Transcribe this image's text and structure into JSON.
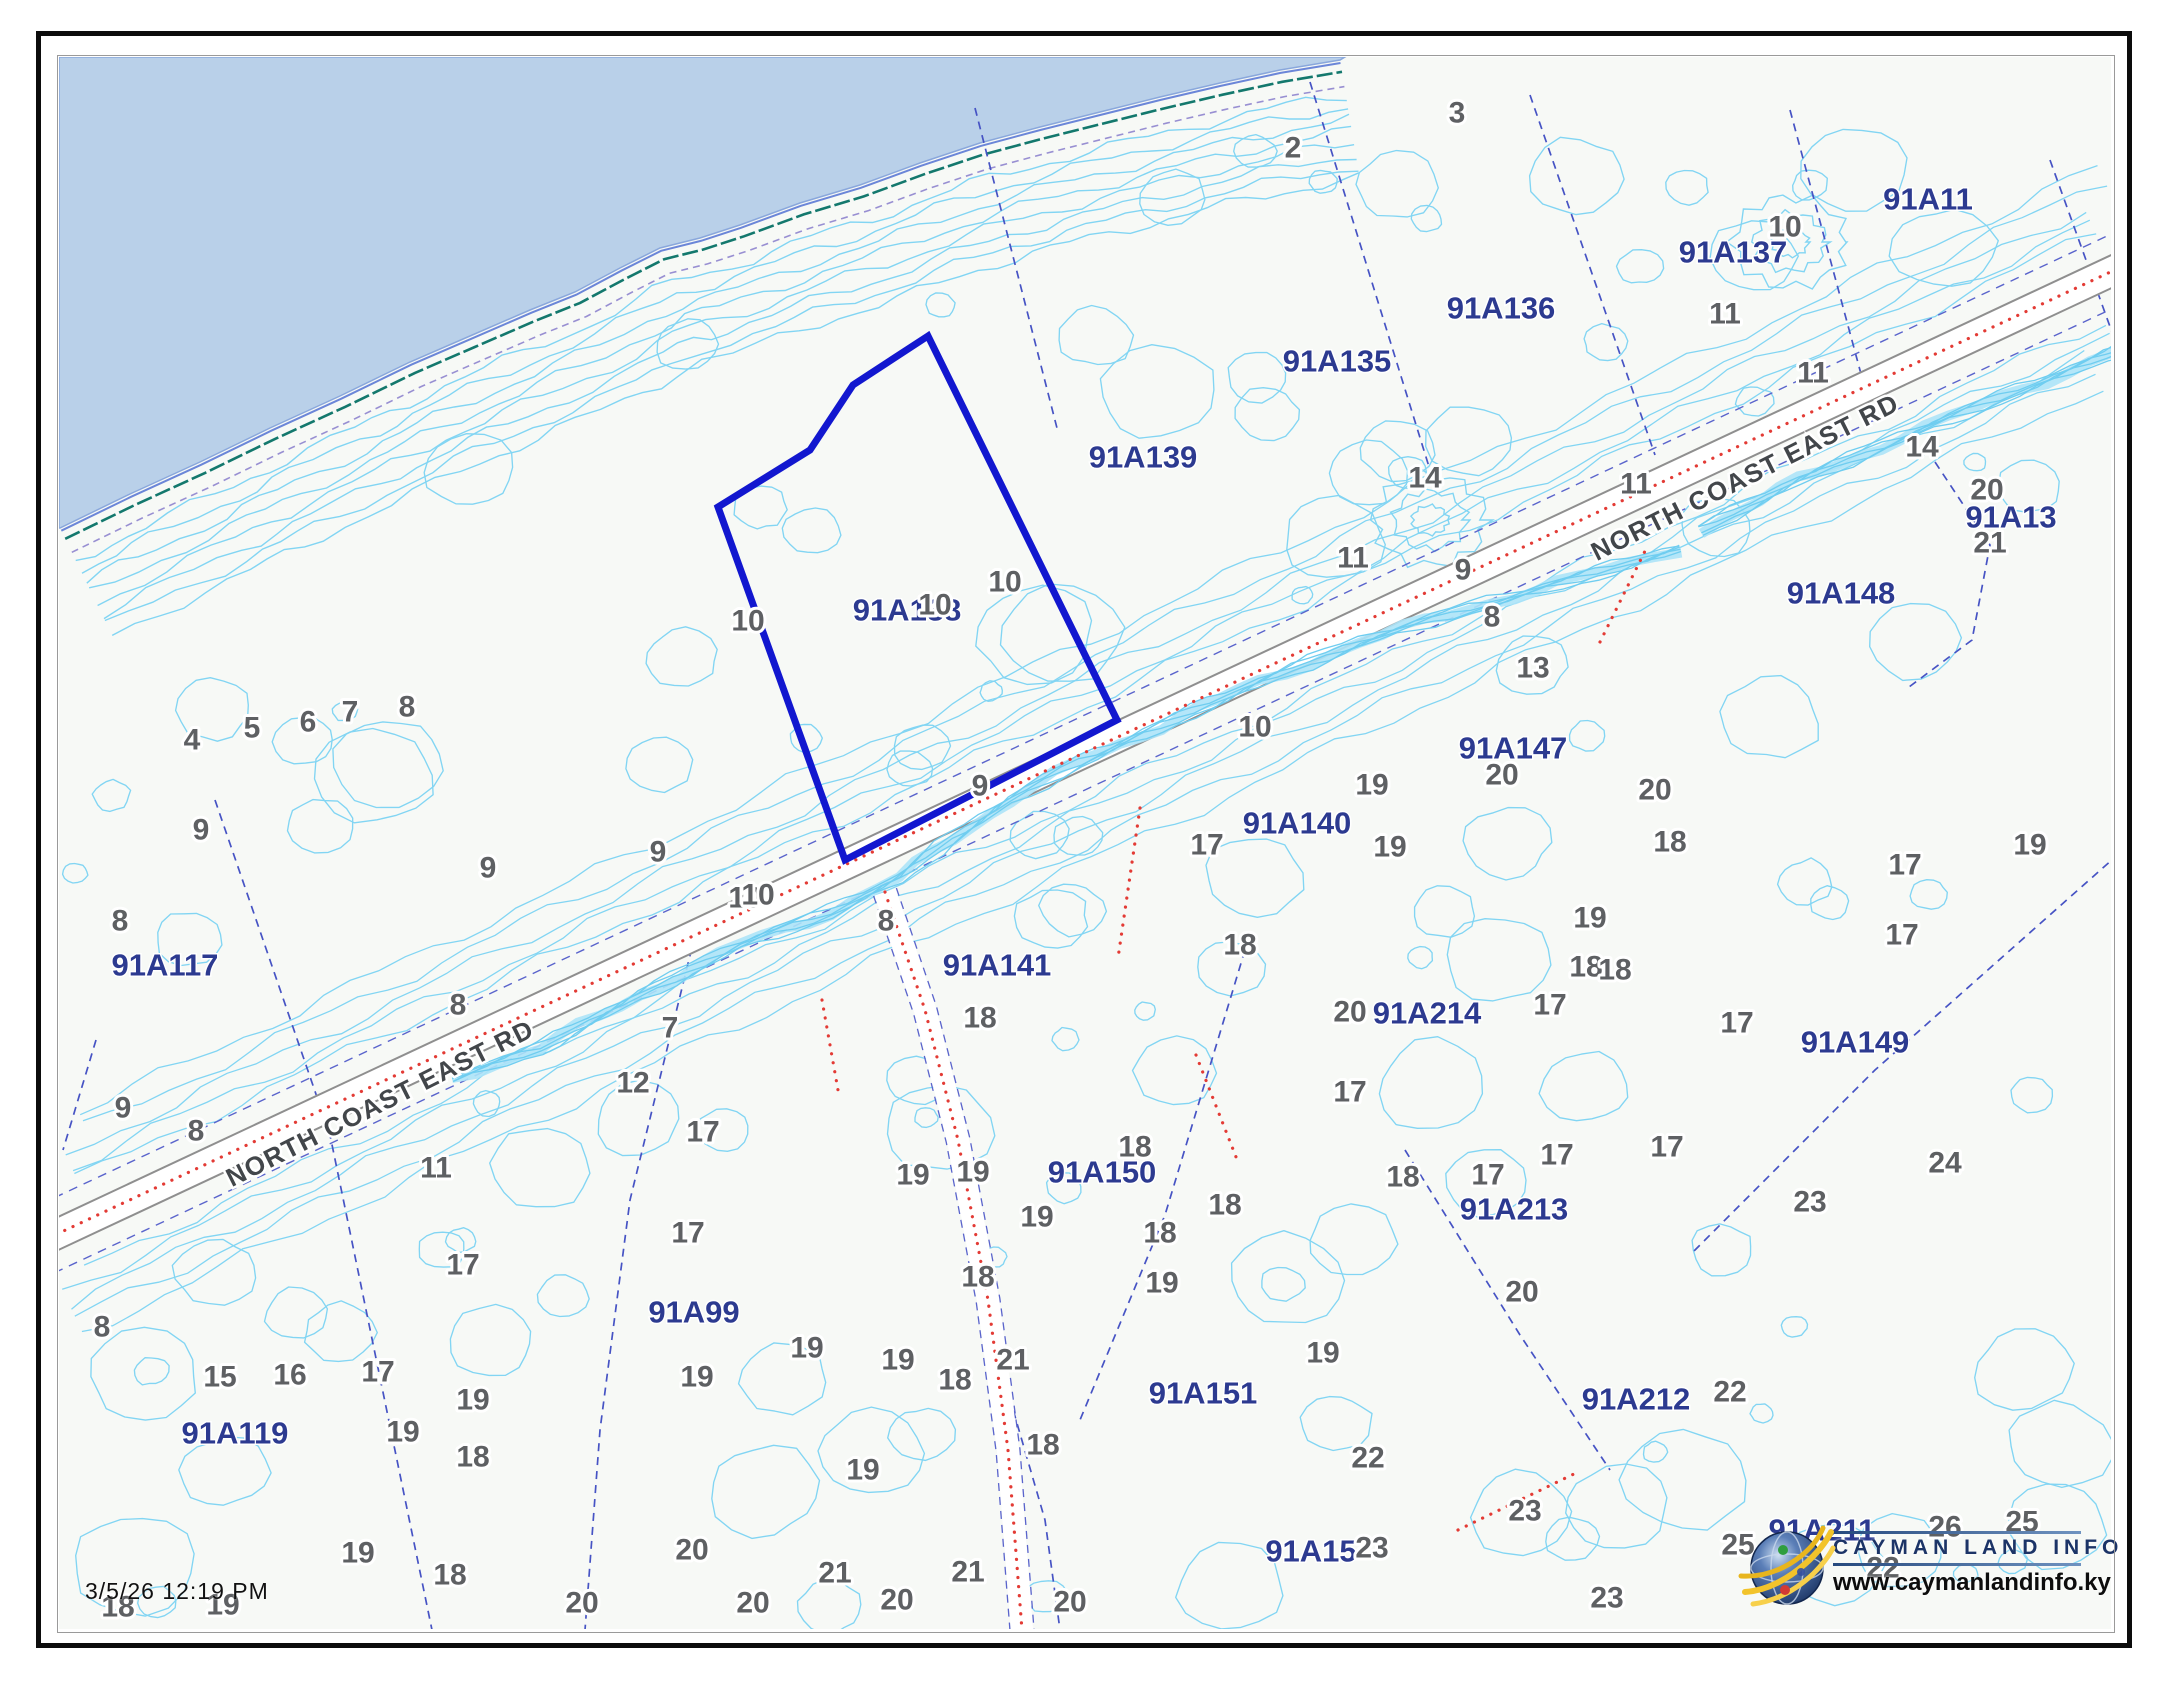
{
  "map": {
    "timestamp": "3/5/26 12:19 PM",
    "road_name": "NORTH COAST EAST RD",
    "selected_parcel_color": "#1217cf"
  },
  "logo": {
    "title": "CAYMAN LAND INFO",
    "url": "www.caymanlandinfo.ky"
  },
  "colors": {
    "water": "#b9d0e9",
    "land": "#f7f9f6",
    "contour": "#82d5f3",
    "stream": "#6fcdf0",
    "coast_teal": "#13786d",
    "coast_blue": "#6b86d8",
    "coast_purple": "#988fd2",
    "boundary_blue": "#4653c4",
    "road_edge": "#8f8f8f",
    "road_fill": "#ffffff",
    "red_dots": "#e33b35",
    "elev_text": "#5e6063",
    "parcel_text": "#2c3a90",
    "road_text": "#42464a",
    "selected": "#1217cf"
  },
  "labels": {
    "roads": [
      {
        "text": "NORTH COAST EAST RD",
        "x": 380,
        "y": 1103,
        "angle": -26.6
      },
      {
        "text": "NORTH COAST EAST RD",
        "x": 1745,
        "y": 477,
        "angle": -26.6
      }
    ],
    "parcels": [
      {
        "text": "91A117",
        "x": 165,
        "y": 965
      },
      {
        "text": "91A119",
        "x": 235,
        "y": 1433
      },
      {
        "text": "91A99",
        "x": 694,
        "y": 1312
      },
      {
        "text": "91A138",
        "x": 907,
        "y": 610
      },
      {
        "text": "91A139",
        "x": 1143,
        "y": 457
      },
      {
        "text": "91A135",
        "x": 1337,
        "y": 361
      },
      {
        "text": "91A136",
        "x": 1501,
        "y": 308
      },
      {
        "text": "91A137",
        "x": 1733,
        "y": 252
      },
      {
        "text": "91A11",
        "x": 1928,
        "y": 199
      },
      {
        "text": "91A13",
        "x": 2011,
        "y": 517
      },
      {
        "text": "91A148",
        "x": 1841,
        "y": 593
      },
      {
        "text": "91A147",
        "x": 1513,
        "y": 748
      },
      {
        "text": "91A140",
        "x": 1297,
        "y": 823
      },
      {
        "text": "91A141",
        "x": 997,
        "y": 965
      },
      {
        "text": "91A214",
        "x": 1427,
        "y": 1013
      },
      {
        "text": "91A149",
        "x": 1855,
        "y": 1042
      },
      {
        "text": "91A150",
        "x": 1102,
        "y": 1172
      },
      {
        "text": "91A213",
        "x": 1514,
        "y": 1209
      },
      {
        "text": "91A151",
        "x": 1203,
        "y": 1393
      },
      {
        "text": "91A212",
        "x": 1636,
        "y": 1399
      },
      {
        "text": "91A15",
        "x": 1311,
        "y": 1551
      },
      {
        "text": "91A211",
        "x": 1822,
        "y": 1530
      }
    ],
    "elevations": [
      [
        2,
        1293,
        148
      ],
      [
        3,
        1457,
        113
      ],
      [
        10,
        1785,
        227
      ],
      [
        11,
        1725,
        314
      ],
      [
        11,
        1813,
        373
      ],
      [
        14,
        1922,
        447
      ],
      [
        20,
        1987,
        490
      ],
      [
        21,
        1990,
        543
      ],
      [
        11,
        1636,
        484
      ],
      [
        14,
        1425,
        478
      ],
      [
        11,
        1353,
        558
      ],
      [
        9,
        1463,
        570
      ],
      [
        8,
        1492,
        617
      ],
      [
        13,
        1533,
        668
      ],
      [
        10,
        1255,
        727
      ],
      [
        19,
        1372,
        785
      ],
      [
        20,
        1502,
        775
      ],
      [
        20,
        1655,
        790
      ],
      [
        18,
        1670,
        842
      ],
      [
        19,
        2030,
        845
      ],
      [
        17,
        1905,
        865
      ],
      [
        17,
        1902,
        935
      ],
      [
        19,
        1590,
        918
      ],
      [
        18,
        1586,
        967
      ],
      [
        17,
        1737,
        1023
      ],
      [
        17,
        1667,
        1147
      ],
      [
        24,
        1945,
        1163
      ],
      [
        23,
        1810,
        1202
      ],
      [
        4,
        192,
        740
      ],
      [
        5,
        252,
        728
      ],
      [
        6,
        308,
        722
      ],
      [
        7,
        350,
        712
      ],
      [
        8,
        407,
        707
      ],
      [
        9,
        201,
        830
      ],
      [
        8,
        120,
        921
      ],
      [
        9,
        488,
        868
      ],
      [
        8,
        458,
        1005
      ],
      [
        9,
        123,
        1108
      ],
      [
        8,
        196,
        1131
      ],
      [
        11,
        436,
        1168
      ],
      [
        12,
        633,
        1083
      ],
      [
        7,
        670,
        1028
      ],
      [
        9,
        658,
        852
      ],
      [
        10,
        745,
        898
      ],
      [
        8,
        886,
        921
      ],
      [
        18,
        980,
        1018
      ],
      [
        10,
        748,
        621
      ],
      [
        10,
        935,
        605
      ],
      [
        10,
        1005,
        582
      ],
      [
        9,
        980,
        786
      ],
      [
        10,
        758,
        895
      ],
      [
        17,
        1207,
        845
      ],
      [
        19,
        1390,
        847
      ],
      [
        18,
        1240,
        945
      ],
      [
        20,
        1350,
        1012
      ],
      [
        17,
        1550,
        1005
      ],
      [
        18,
        1615,
        970
      ],
      [
        17,
        1350,
        1092
      ],
      [
        18,
        1135,
        1147
      ],
      [
        18,
        1225,
        1205
      ],
      [
        18,
        1160,
        1233
      ],
      [
        19,
        1162,
        1283
      ],
      [
        20,
        1522,
        1292
      ],
      [
        19,
        1323,
        1353
      ],
      [
        22,
        1368,
        1458
      ],
      [
        23,
        1525,
        1511
      ],
      [
        17,
        1488,
        1175
      ],
      [
        17,
        1557,
        1155
      ],
      [
        18,
        1403,
        1177
      ],
      [
        19,
        913,
        1175
      ],
      [
        19,
        973,
        1172
      ],
      [
        19,
        1037,
        1217
      ],
      [
        17,
        688,
        1233
      ],
      [
        17,
        703,
        1132
      ],
      [
        18,
        978,
        1277
      ],
      [
        19,
        807,
        1348
      ],
      [
        19,
        898,
        1360
      ],
      [
        18,
        955,
        1380
      ],
      [
        21,
        1013,
        1360
      ],
      [
        19,
        697,
        1377
      ],
      [
        18,
        1043,
        1445
      ],
      [
        19,
        863,
        1470
      ],
      [
        20,
        692,
        1550
      ],
      [
        20,
        582,
        1603
      ],
      [
        20,
        753,
        1603
      ],
      [
        21,
        835,
        1573
      ],
      [
        20,
        897,
        1600
      ],
      [
        21,
        968,
        1572
      ],
      [
        20,
        1070,
        1602
      ],
      [
        8,
        102,
        1327
      ],
      [
        17,
        463,
        1265
      ],
      [
        15,
        220,
        1377
      ],
      [
        16,
        290,
        1375
      ],
      [
        17,
        378,
        1372
      ],
      [
        19,
        473,
        1400
      ],
      [
        19,
        403,
        1432
      ],
      [
        18,
        473,
        1457
      ],
      [
        19,
        358,
        1553
      ],
      [
        18,
        450,
        1575
      ],
      [
        18,
        118,
        1607
      ],
      [
        19,
        223,
        1605
      ],
      [
        22,
        1730,
        1392
      ],
      [
        23,
        1607,
        1598
      ],
      [
        25,
        1738,
        1545
      ],
      [
        26,
        1945,
        1527
      ],
      [
        25,
        2022,
        1522
      ],
      [
        22,
        1883,
        1568
      ],
      [
        23,
        1372,
        1548
      ]
    ]
  },
  "geometry": {
    "map_rect": [
      59,
      57,
      2052,
      1572
    ],
    "coast": [
      [
        60,
        528
      ],
      [
        130,
        494
      ],
      [
        200,
        462
      ],
      [
        270,
        428
      ],
      [
        340,
        396
      ],
      [
        410,
        362
      ],
      [
        470,
        336
      ],
      [
        530,
        310
      ],
      [
        575,
        292
      ],
      [
        620,
        268
      ],
      [
        660,
        248
      ],
      [
        700,
        238
      ],
      [
        740,
        225
      ],
      [
        800,
        203
      ],
      [
        860,
        185
      ],
      [
        920,
        163
      ],
      [
        980,
        143
      ],
      [
        1040,
        127
      ],
      [
        1100,
        112
      ],
      [
        1160,
        97
      ],
      [
        1220,
        83
      ],
      [
        1280,
        70
      ],
      [
        1340,
        60
      ]
    ],
    "road": [
      [
        40,
        1242
      ],
      [
        2168,
        245
      ]
    ],
    "track": [
      [
        885,
        892
      ],
      [
        925,
        1010
      ],
      [
        958,
        1140
      ],
      [
        988,
        1300
      ],
      [
        1008,
        1450
      ],
      [
        1022,
        1630
      ]
    ],
    "selected_parcel": [
      [
        928,
        336
      ],
      [
        853,
        385
      ],
      [
        810,
        450
      ],
      [
        718,
        507
      ],
      [
        845,
        860
      ],
      [
        1117,
        720
      ]
    ],
    "streams": [
      [
        [
          452,
          1078
        ],
        [
          540,
          1048
        ],
        [
          640,
          995
        ],
        [
          740,
          945
        ],
        [
          830,
          912
        ],
        [
          900,
          878
        ],
        [
          952,
          838
        ],
        [
          1010,
          800
        ],
        [
          1080,
          762
        ],
        [
          1160,
          726
        ],
        [
          1260,
          682
        ],
        [
          1360,
          642
        ],
        [
          1470,
          608
        ],
        [
          1580,
          578
        ],
        [
          1680,
          548
        ]
      ],
      [
        [
          1700,
          530
        ],
        [
          1800,
          480
        ],
        [
          1900,
          438
        ],
        [
          2000,
          398
        ],
        [
          2090,
          362
        ],
        [
          2168,
          330
        ]
      ]
    ],
    "rings": [
      [
        1430,
        520
      ],
      [
        1790,
        242
      ]
    ],
    "boundaries": [
      [
        [
          975,
          108
        ],
        [
          1058,
          432
        ]
      ],
      [
        [
          1310,
          82
        ],
        [
          1430,
          470
        ]
      ],
      [
        [
          1530,
          95
        ],
        [
          1655,
          455
        ]
      ],
      [
        [
          1790,
          110
        ],
        [
          1868,
          400
        ]
      ],
      [
        [
          2050,
          160
        ],
        [
          2122,
          360
        ]
      ],
      [
        [
          215,
          800
        ],
        [
          330,
          1135
        ],
        [
          432,
          1630
        ]
      ],
      [
        [
          695,
          935
        ],
        [
          630,
          1200
        ],
        [
          600,
          1430
        ],
        [
          585,
          1630
        ]
      ],
      [
        [
          1245,
          950
        ],
        [
          1165,
          1215
        ],
        [
          1080,
          1420
        ]
      ],
      [
        [
          990,
          1330
        ],
        [
          1045,
          1520
        ],
        [
          1060,
          1630
        ]
      ],
      [
        [
          2140,
          835
        ],
        [
          1875,
          1070
        ],
        [
          1690,
          1255
        ]
      ],
      [
        [
          1935,
          462
        ],
        [
          1990,
          545
        ],
        [
          1972,
          640
        ],
        [
          1905,
          690
        ]
      ],
      [
        [
          1405,
          1150
        ],
        [
          1520,
          1335
        ],
        [
          1610,
          1470
        ]
      ],
      [
        [
          96,
          1040
        ],
        [
          63,
          1150
        ]
      ]
    ],
    "red_dotted_extra": [
      [
        [
          1140,
          808
        ],
        [
          1118,
          958
        ]
      ],
      [
        [
          1196,
          1055
        ],
        [
          1238,
          1162
        ]
      ],
      [
        [
          1600,
          642
        ],
        [
          1648,
          545
        ]
      ],
      [
        [
          1458,
          1530
        ],
        [
          1578,
          1472
        ]
      ],
      [
        [
          822,
          1000
        ],
        [
          838,
          1090
        ]
      ]
    ]
  }
}
